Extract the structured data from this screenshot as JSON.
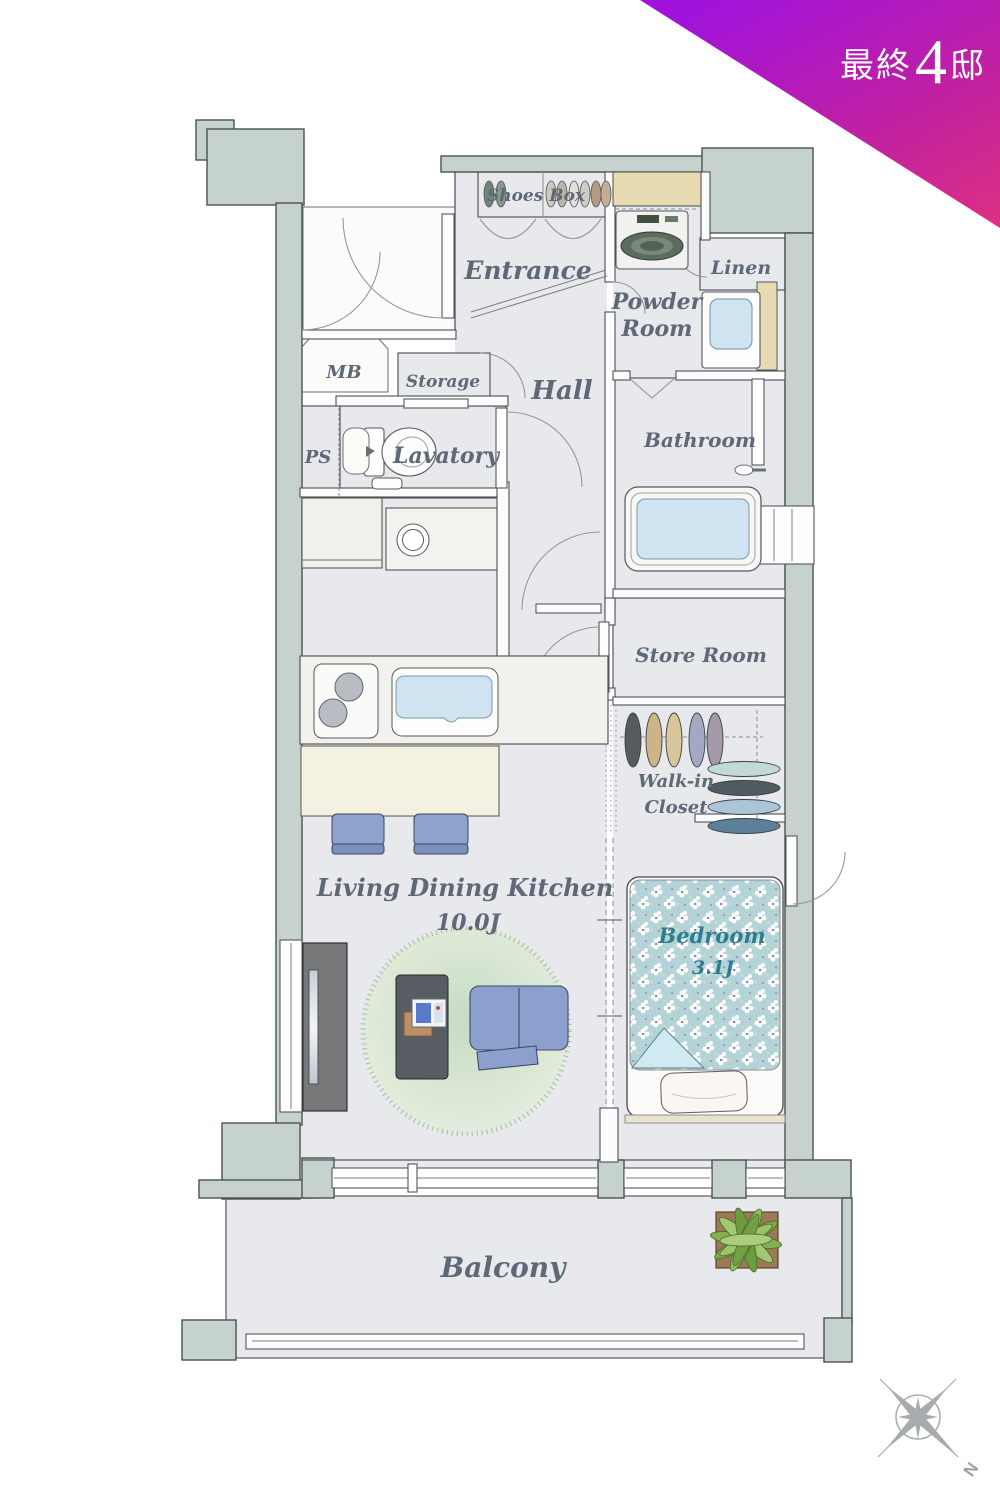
{
  "badge": {
    "prefix": "最終",
    "number": "4",
    "suffix": "邸",
    "full_text": "最終4邸"
  },
  "labels": {
    "shoes_box": "Shoes Box",
    "entrance": "Entrance",
    "powder_1": "Powder",
    "powder_2": "Room",
    "linen": "Linen",
    "mb": "MB",
    "storage": "Storage",
    "hall": "Hall",
    "ps": "PS",
    "lavatory": "Lavatory",
    "bathroom": "Bathroom",
    "store_room": "Store Room",
    "wic_1": "Walk-in",
    "wic_2": "Closet",
    "ldk_1": "Living Dining Kitchen",
    "ldk_2": "10.0J",
    "bedroom_1": "Bedroom",
    "bedroom_2": "3.1J",
    "balcony": "Balcony"
  },
  "compass": {
    "north": "N"
  },
  "colors": {
    "wall": "#c6d2cd",
    "floor": "#e8e9ec",
    "balcony_floor": "#eef0ef",
    "cabinet_tan": "#e7dbb2",
    "fixture_blue": "#cfe4f0",
    "label_gray": "#5e6876",
    "bedroom_label_teal": "#2e7d8e",
    "badge_gradient_start": "#a113da",
    "badge_gradient_end": "#ea3a70",
    "compass_gray": "#a8abad"
  }
}
